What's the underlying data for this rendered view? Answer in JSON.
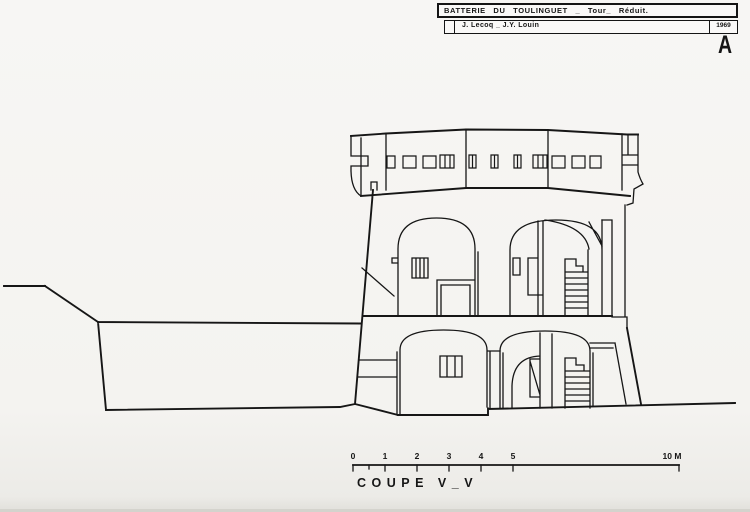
{
  "colors": {
    "ink": "#161616",
    "paper": "#f4f3f0"
  },
  "title_block": {
    "title": "BATTERIE DU TOULINGUET _ Tour_ Réduit.",
    "authors": "J. Lecoq _ J.Y. Louin",
    "year": "1969",
    "plate_letter": "A"
  },
  "scale_bar": {
    "ticks": [
      {
        "label": "0"
      },
      {
        "label": "1"
      },
      {
        "label": "2"
      },
      {
        "label": "3"
      },
      {
        "label": "4"
      },
      {
        "label": "5"
      }
    ],
    "end_label": "10 M"
  },
  "caption": "COUPE V_V"
}
